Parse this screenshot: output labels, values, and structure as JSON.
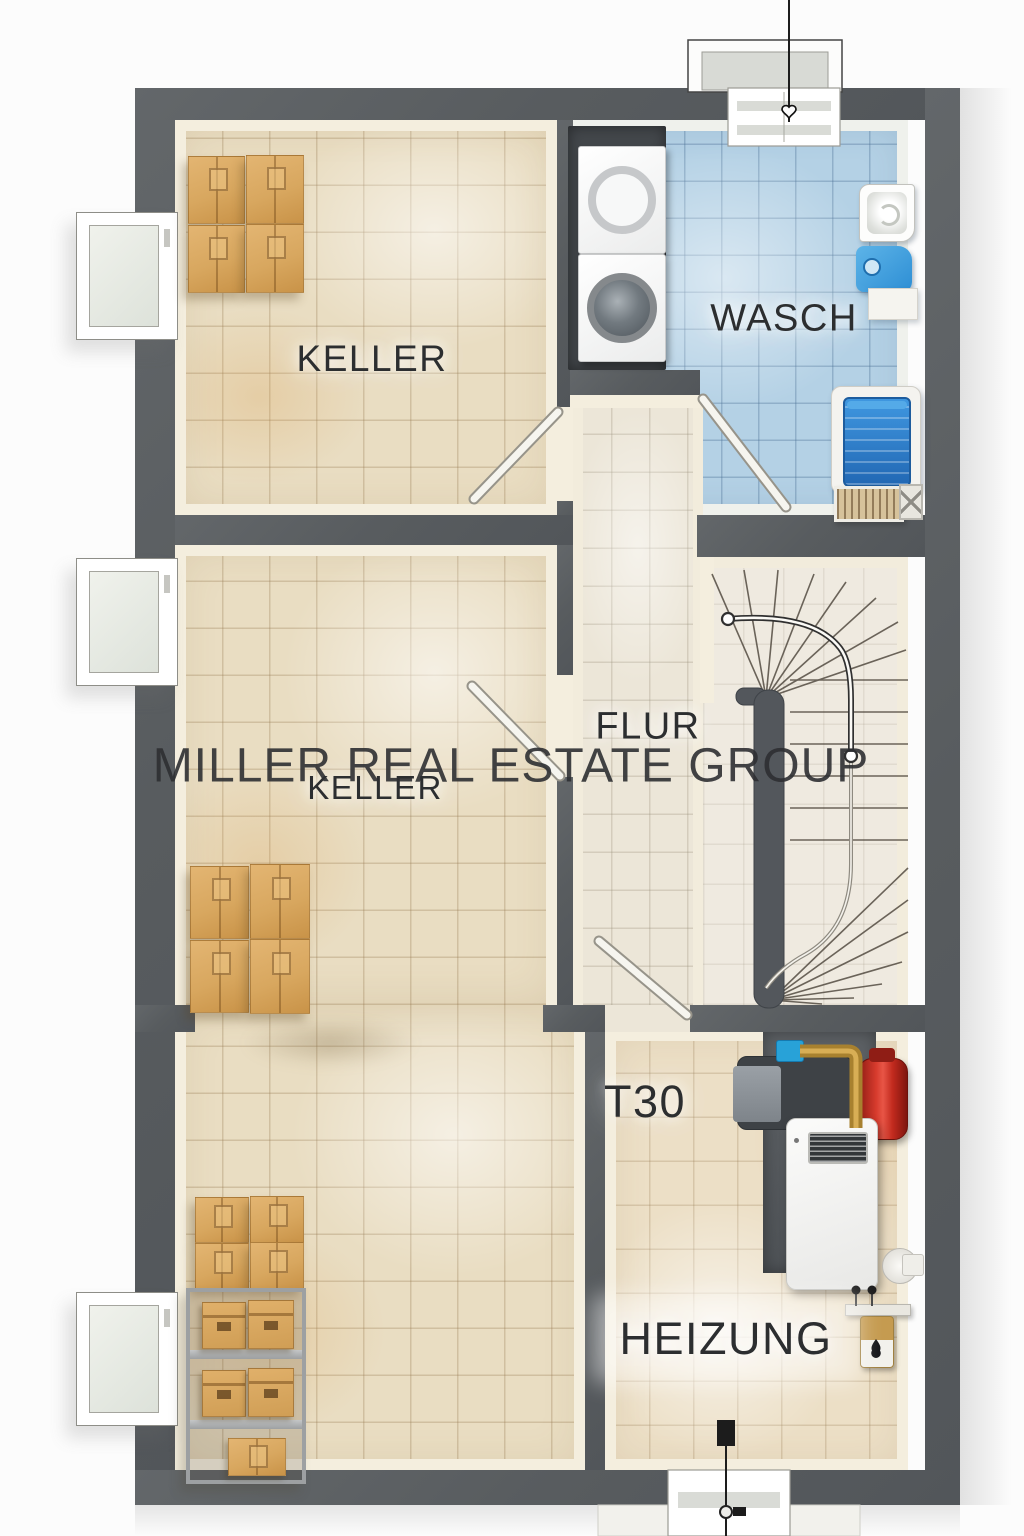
{
  "watermark": {
    "text": "MILLER REAL ESTATE GROUP"
  },
  "rooms": {
    "keller_top": {
      "label": "KELLER"
    },
    "wasch": {
      "label": "WASCH"
    },
    "flur": {
      "label": "FLUR"
    },
    "keller_main": {
      "label": "KELLER"
    },
    "heizung": {
      "label": "HEIZUNG"
    },
    "fire_door": {
      "label": "T30"
    }
  },
  "palette": {
    "wall": "#5b5e61",
    "floor_beige": "#e9ddc2",
    "floor_blue": "#b4d1e5",
    "floor_flur": "#ece6d8",
    "stair_floor": "#efeae0",
    "box_tan": "#d8a75f",
    "accent_red": "#c5271e",
    "accent_blue": "#2f8fd6",
    "brass": "#b28a3c",
    "label_ink": "#2c2e30"
  },
  "fixtures": [
    {
      "name": "washer-dryer-stack"
    },
    {
      "name": "wash-basin"
    },
    {
      "name": "detergent-jug"
    },
    {
      "name": "laundry-tub"
    },
    {
      "name": "washboard"
    },
    {
      "name": "winder-staircase"
    },
    {
      "name": "handrail"
    },
    {
      "name": "moving-boxes"
    },
    {
      "name": "storage-rack"
    },
    {
      "name": "gas-boiler"
    },
    {
      "name": "expansion-tank"
    },
    {
      "name": "water-heater"
    },
    {
      "name": "cellar-windows"
    },
    {
      "name": "drain-pipe-markers"
    }
  ]
}
